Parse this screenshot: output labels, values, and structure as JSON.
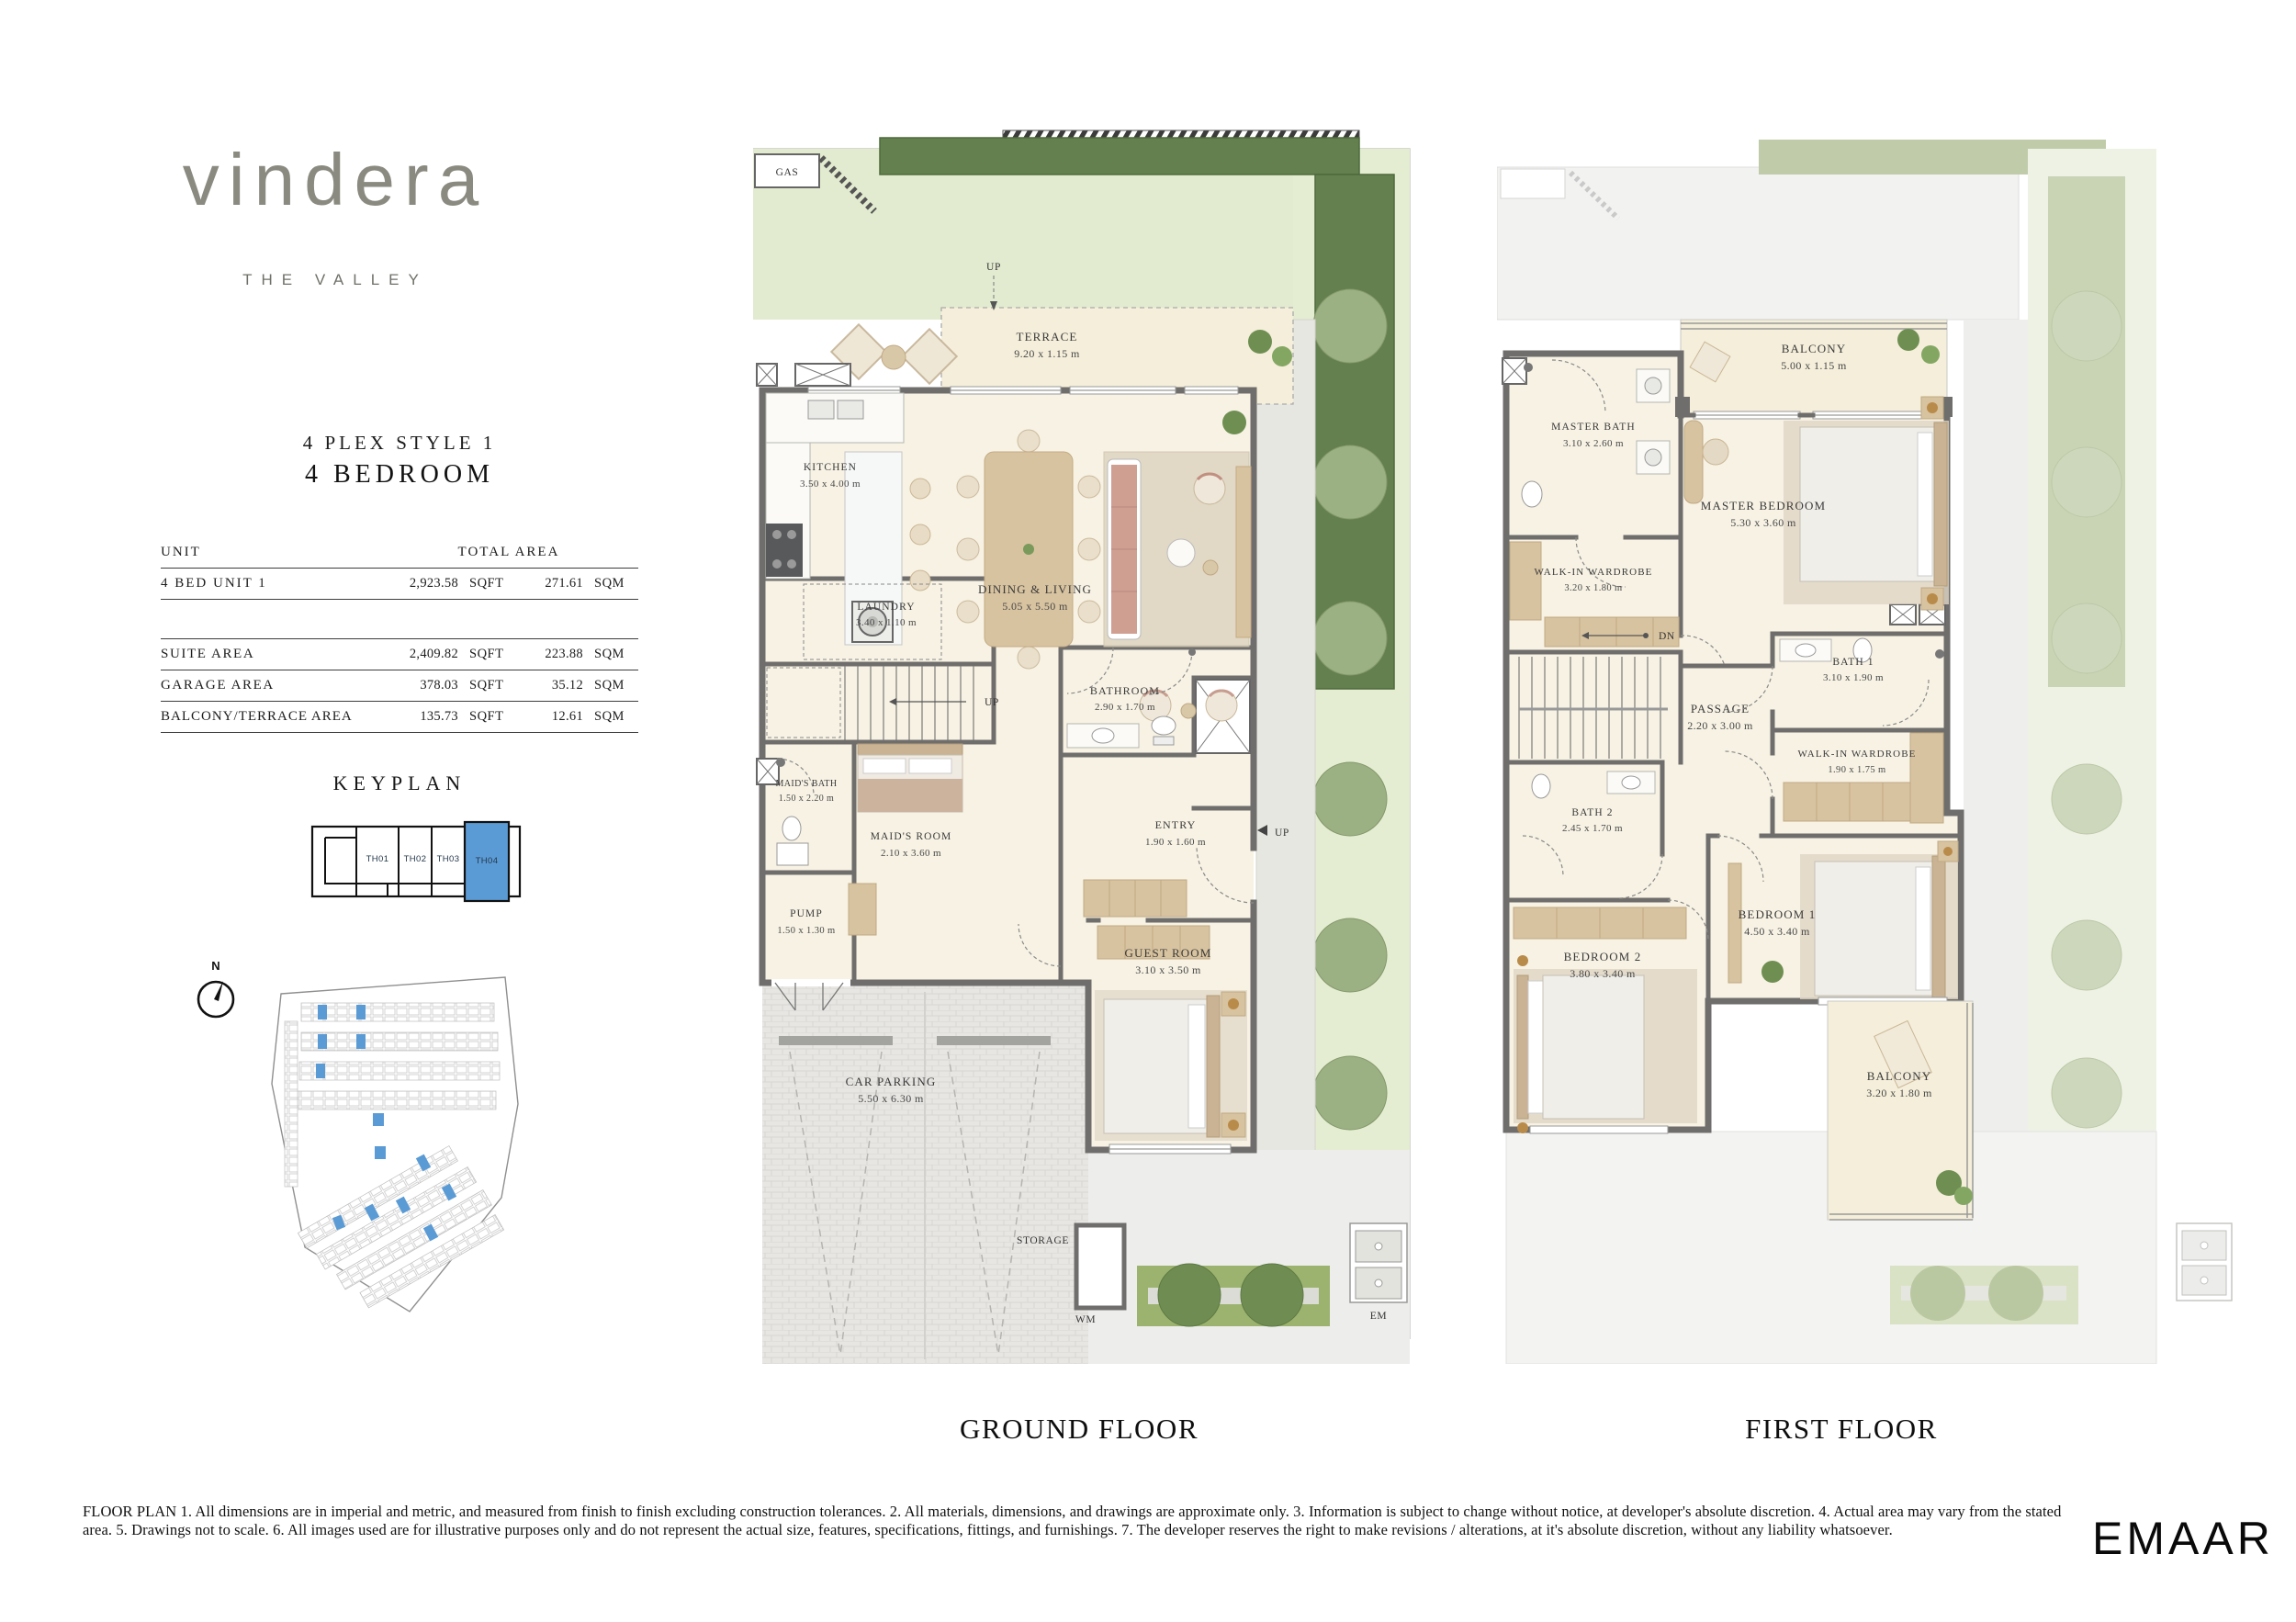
{
  "colors": {
    "keyplan_highlight": "#5b9bd5",
    "hedge_green": "#63804e",
    "lawn_green": "#e2ebcf",
    "wall_gray": "#6f6e6c",
    "floor_cream": "#f7f2e4"
  },
  "brand": {
    "wordmark": "vindera",
    "tagline": "THE VALLEY"
  },
  "title": {
    "style": "4 PLEX STYLE 1",
    "bedrooms": "4 BEDROOM"
  },
  "area_table": {
    "header": {
      "unit": "UNIT",
      "total": "TOTAL AREA"
    },
    "main_row": {
      "label": "4 BED UNIT 1",
      "sqft": "2,923.58",
      "sqft_u": "SQFT",
      "sqm": "271.61",
      "sqm_u": "SQM"
    },
    "rows": [
      {
        "label": "SUITE AREA",
        "sqft": "2,409.82",
        "sqft_u": "SQFT",
        "sqm": "223.88",
        "sqm_u": "SQM"
      },
      {
        "label": "GARAGE AREA",
        "sqft": "378.03",
        "sqft_u": "SQFT",
        "sqm": "35.12",
        "sqm_u": "SQM"
      },
      {
        "label": "BALCONY/TERRACE AREA",
        "sqft": "135.73",
        "sqft_u": "SQFT",
        "sqm": "12.61",
        "sqm_u": "SQM"
      }
    ]
  },
  "keyplan": {
    "title": "KEYPLAN",
    "cells": [
      "TH01",
      "TH02",
      "TH03",
      "TH04"
    ],
    "highlighted": "TH04"
  },
  "compass": {
    "label": "N"
  },
  "ground": {
    "caption": "GROUND FLOOR",
    "labels": {
      "gas": "GAS",
      "up_top": "UP",
      "up_stairs": "UP",
      "up_entry": "UP",
      "storage": "STORAGE",
      "wm": "WM",
      "em": "EM"
    },
    "rooms": {
      "terrace": {
        "name": "TERRACE",
        "dims": "9.20 x  1.15 m"
      },
      "kitchen": {
        "name": "KITCHEN",
        "dims": "3.50 x 4.00 m"
      },
      "dining": {
        "name": "DINING & LIVING",
        "dims": "5.05 x 5.50 m"
      },
      "laundry": {
        "name": "LAUNDRY",
        "dims": "3.40 x 1.10 m"
      },
      "bathroom": {
        "name": "BATHROOM",
        "dims": "2.90 x 1.70 m"
      },
      "maids_bath": {
        "name": "MAID'S BATH",
        "dims": "1.50 x 2.20 m"
      },
      "maids_room": {
        "name": "MAID'S ROOM",
        "dims": "2.10 x 3.60 m"
      },
      "entry": {
        "name": "ENTRY",
        "dims": "1.90 x 1.60 m"
      },
      "pump": {
        "name": "PUMP",
        "dims": "1.50 x 1.30 m"
      },
      "guest": {
        "name": "GUEST ROOM",
        "dims": "3.10 x 3.50 m"
      },
      "parking": {
        "name": "CAR PARKING",
        "dims": "5.50 x 6.30 m"
      }
    }
  },
  "first": {
    "caption": "FIRST FLOOR",
    "labels": {
      "dn": "DN"
    },
    "rooms": {
      "balcony_top": {
        "name": "BALCONY",
        "dims": "5.00 x 1.15 m"
      },
      "master_bath": {
        "name": "MASTER BATH",
        "dims": "3.10 x 2.60 m"
      },
      "master_bedroom": {
        "name": "MASTER BEDROOM",
        "dims": "5.30 x 3.60 m"
      },
      "wiw_master": {
        "name": "WALK-IN WARDROBE",
        "dims": "3.20 x 1.80 m"
      },
      "passage": {
        "name": "PASSAGE",
        "dims": "2.20 x 3.00 m"
      },
      "bath1": {
        "name": "BATH 1",
        "dims": "3.10 x 1.90 m"
      },
      "wiw1": {
        "name": "WALK-IN WARDROBE",
        "dims": "1.90 x 1.75 m"
      },
      "bath2": {
        "name": "BATH 2",
        "dims": "2.45 x 1.70 m"
      },
      "bedroom2": {
        "name": "BEDROOM 2",
        "dims": "3.80 x 3.40 m"
      },
      "bedroom1": {
        "name": "BEDROOM 1",
        "dims": "4.50 x 3.40 m"
      },
      "balcony_bottom": {
        "name": "BALCONY",
        "dims": "3.20 x 1.80 m"
      }
    }
  },
  "footer": {
    "disclaimer": "FLOOR PLAN 1. All dimensions are in imperial and metric, and measured from finish to finish excluding construction tolerances. 2. All materials, dimensions, and drawings are approximate only. 3. Information is subject to change without notice, at developer's absolute discretion. 4. Actual area may vary from the stated area. 5. Drawings not to scale. 6. All images used are for illustrative purposes only and do not represent the actual size, features, specifications, fittings, and furnishings. 7. The developer reserves the right to make revisions / alterations, at it's absolute discretion, without any liability whatsoever.",
    "logo": "EMAAR"
  }
}
